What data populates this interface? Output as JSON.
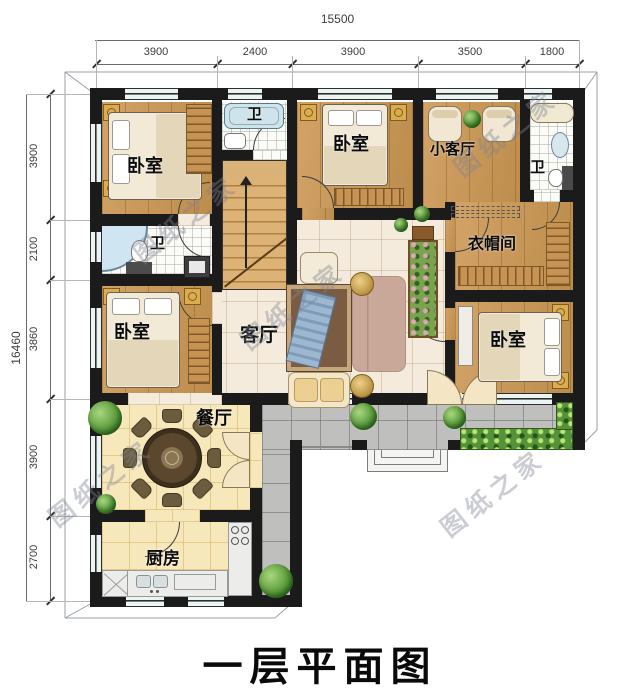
{
  "title": "一层平面图",
  "watermark": {
    "text": "图纸之家"
  },
  "dimensions": {
    "top": {
      "total": "15500",
      "segments": [
        "3900",
        "2400",
        "3900",
        "3500",
        "1800"
      ]
    },
    "left": {
      "total": "16460",
      "segments": [
        "3900",
        "2100",
        "3860",
        "3900",
        "2700"
      ]
    }
  },
  "rooms": {
    "bedroom_top_left": "卧室",
    "bedroom_top_center": "卧室",
    "bedroom_mid_left": "卧室",
    "bedroom_mid_right": "卧室",
    "bath_top_center": "卫",
    "bath_top_right": "卫",
    "bath_mid_left": "卫",
    "small_living": "小客厅",
    "cloakroom": "衣帽间",
    "living": "客厅",
    "dining": "餐厅",
    "kitchen": "厨房"
  },
  "colors": {
    "wall": "#1b1b1b",
    "wood_floor": "#c8995e",
    "tile_hall": "#f4ebdc",
    "tile_kitchen": "#f7e8bc",
    "tile_bath": "#fbfbf8",
    "porch": "#bfbfbd",
    "greenery": "#55923a",
    "dim_text": "#3c3c3c",
    "watermark_gray": "#7d8391"
  }
}
